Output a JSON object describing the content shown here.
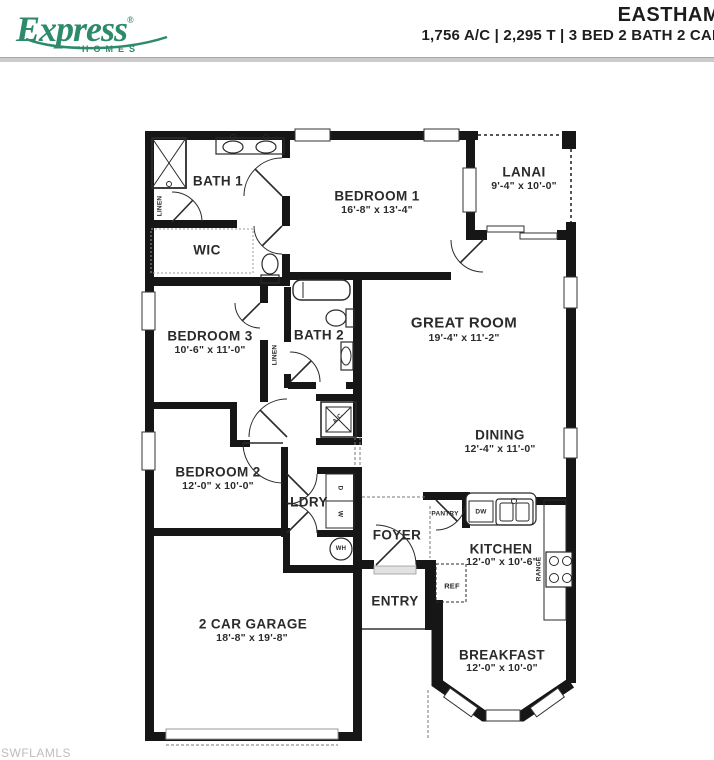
{
  "header": {
    "brand": "Express",
    "brand_registered": "®",
    "brand_sub": "HOMES",
    "brand_color": "#2d8a6b",
    "title": "EASTHAM",
    "specs": "1,756 A/C | 2,295 T  |  3 BED  2 BATH  2 CAR"
  },
  "watermark": "SWFLAMLS",
  "floor_plan": {
    "rooms": {
      "bath1": {
        "name": "BATH 1"
      },
      "wic": {
        "name": "WIC"
      },
      "bedroom1": {
        "name": "BEDROOM 1",
        "dims": "16'-8\" x 13'-4\""
      },
      "lanai": {
        "name": "LANAI",
        "dims": "9'-4\" x 10'-0\""
      },
      "great_room": {
        "name": "GREAT ROOM",
        "dims": "19'-4\" x 11'-2\""
      },
      "bedroom3": {
        "name": "BEDROOM 3",
        "dims": "10'-6\" x 11'-0\""
      },
      "bath2": {
        "name": "BATH 2"
      },
      "dining": {
        "name": "DINING",
        "dims": "12'-4\" x 11'-0\""
      },
      "bedroom2": {
        "name": "BEDROOM 2",
        "dims": "12'-0\" x 10'-0\""
      },
      "laundry": {
        "name": "LDRY"
      },
      "foyer": {
        "name": "FOYER"
      },
      "entry": {
        "name": "ENTRY"
      },
      "kitchen": {
        "name": "KITCHEN",
        "dims": "12'-0\" x 10'-6\""
      },
      "garage": {
        "name": "2 CAR GARAGE",
        "dims": "18'-8\" x 19'-8\""
      },
      "breakfast": {
        "name": "BREAKFAST",
        "dims": "12'-0\" x 10'-0\""
      }
    },
    "fixtures": {
      "linen1": "LINEN",
      "linen2": "LINEN",
      "pantry": "PANTRY",
      "dishwasher": "DW",
      "refrigerator": "REF",
      "range": "RANGE",
      "dryer": "D",
      "washer": "W",
      "water_heater": "WH",
      "ac": "A/C"
    }
  }
}
